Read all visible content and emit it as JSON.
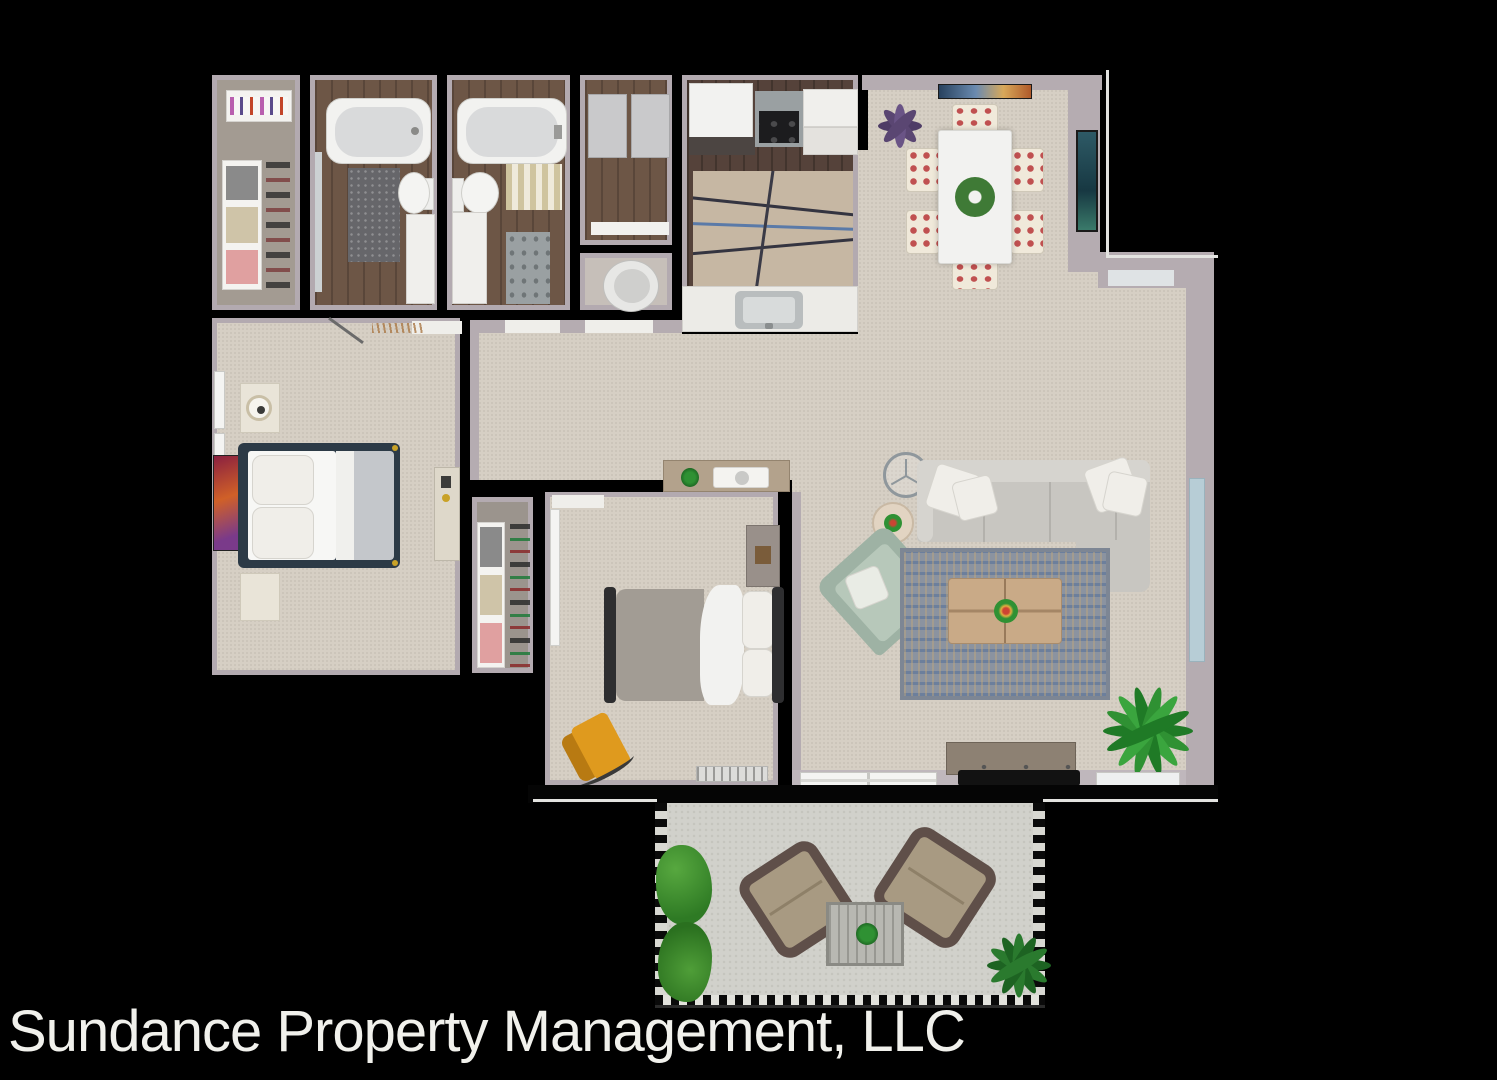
{
  "watermark": {
    "text": "Sundance Property Management, LLC",
    "color": "#f1f1ec"
  },
  "plan": {
    "type": "apartment-floor-plan-3d-top-view",
    "background": "#000000",
    "palette": {
      "wall_face": "#b5acb1",
      "carpet": "#d6cfc4",
      "bath_wood": "#6d5646",
      "kitchen_wood": "#55423a",
      "patio_concrete": "#d1d1cb",
      "sofa_gray": "#c8c6c1",
      "accent_sage": "#a9bcae",
      "accent_orange": "#df9a1e",
      "rug_blue": "#8b93a0",
      "plant_green": "#2f9133",
      "plant_purple": "#5a4672"
    },
    "rooms": [
      {
        "name": "walk-in-closet",
        "furniture": [
          "hanging-rod-with-clothes",
          "shelving-unit",
          "shoe-rack"
        ]
      },
      {
        "name": "bathroom-1",
        "furniture": [
          "bathtub",
          "toilet",
          "vanity",
          "dark-rug",
          "mirror"
        ]
      },
      {
        "name": "bathroom-2",
        "furniture": [
          "bathtub",
          "toilet",
          "vanity",
          "striped-rug",
          "bath-mat"
        ]
      },
      {
        "name": "linen-closet",
        "furniture": [
          "cabinet",
          "cabinet",
          "shelf"
        ]
      },
      {
        "name": "water-closet",
        "furniture": [
          "toilet"
        ]
      },
      {
        "name": "kitchen",
        "furniture": [
          "refrigerator",
          "range-cooktop",
          "upper-cabinet",
          "area-rug",
          "sink-counter"
        ]
      },
      {
        "name": "dining-area",
        "furniture": [
          "dining-table",
          "dining-chairs-x6",
          "wreath-centerpiece",
          "wall-art",
          "purple-plant",
          "framed-picture"
        ]
      },
      {
        "name": "living-room",
        "furniture": [
          "sectional-sofa",
          "chaise",
          "throw-pillows",
          "sage-armchair",
          "area-rug",
          "coffee-table",
          "floor-lamp",
          "round-side-table",
          "media-console",
          "tv",
          "floor-plant",
          "sliding-door",
          "window"
        ]
      },
      {
        "name": "bedroom-1",
        "furniture": [
          "bed",
          "nightstand",
          "table-lamp",
          "cube-table",
          "dresser",
          "wall-art",
          "windows",
          "door-swing"
        ]
      },
      {
        "name": "bedroom-1-closet",
        "furniture": [
          "shelving-unit",
          "shoe-rack"
        ]
      },
      {
        "name": "bedroom-2",
        "furniture": [
          "bed",
          "dresser",
          "orange-chair",
          "baseboard-heater",
          "open-door"
        ]
      },
      {
        "name": "patio",
        "furniture": [
          "wicker-chair",
          "wicker-chair",
          "patio-table",
          "hedge-planter",
          "potted-palm",
          "railing"
        ]
      }
    ]
  }
}
